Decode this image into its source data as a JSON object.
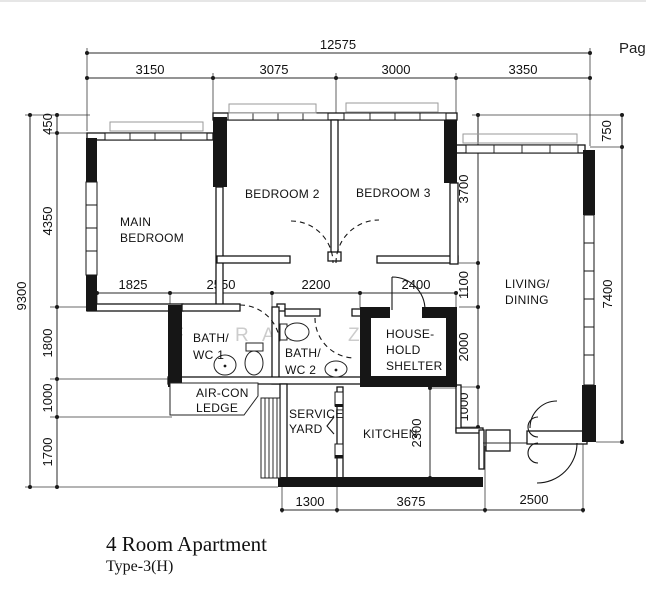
{
  "page_label": "Page",
  "plan_title": {
    "line1": "4 Room Apartment",
    "line2": "Type-3(H)"
  },
  "rooms": {
    "main_bedroom": {
      "line1": "MAIN",
      "line2": "BEDROOM"
    },
    "bedroom2": "BEDROOM 2",
    "bedroom3": "BEDROOM 3",
    "living_dining": {
      "line1": "LIVING/",
      "line2": "DINING"
    },
    "bath_wc_1": {
      "line1": "BATH/",
      "line2": "WC 1"
    },
    "bath_wc_2": {
      "line1": "BATH/",
      "line2": "WC 2"
    },
    "household_shelter": {
      "line1": "HOUSE-",
      "line2": "HOLD",
      "line3": "SHELTER"
    },
    "aircon_ledge": {
      "line1": "AIR-CON",
      "line2": "LEDGE"
    },
    "service_yard": {
      "line1": "SERVICE",
      "line2": "YARD"
    },
    "kitchen": "KITCHEN"
  },
  "dimensions": {
    "overall_width": "12575",
    "top": [
      "3150",
      "3075",
      "3000",
      "3350"
    ],
    "middle": [
      "1825",
      "2550",
      "2200",
      "2400"
    ],
    "bottom": [
      "1300",
      "3675",
      "2500"
    ],
    "overall_height": "9300",
    "left": [
      "450",
      "4350",
      "1800",
      "1000",
      "1700"
    ],
    "right_outer": [
      "750",
      "7400"
    ],
    "right_inner": [
      "3700",
      "1100",
      "2000",
      "1000"
    ],
    "kitchen_depth": "2300"
  },
  "watermark": {
    "letters": [
      "F",
      "R",
      "A",
      "D",
      "Z",
      "A",
      "K"
    ]
  },
  "colors": {
    "wall": "#161616",
    "dim_line": "#222222",
    "ledge_outline": "#9a9a9a",
    "watermark": "#cccccc",
    "background": "#ffffff"
  }
}
